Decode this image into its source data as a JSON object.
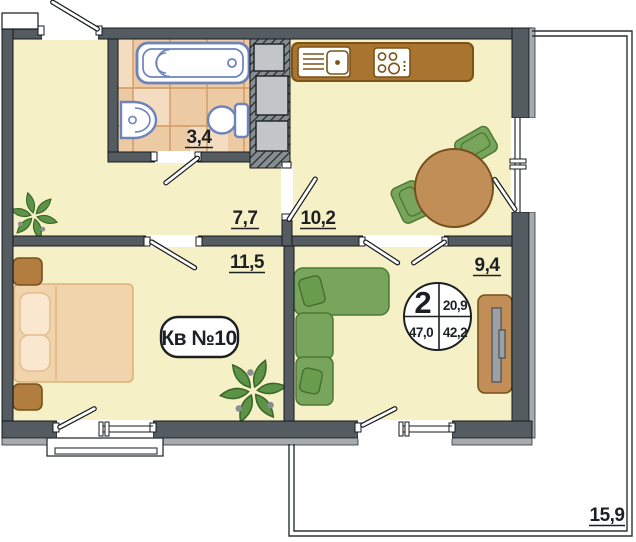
{
  "plan": {
    "apartment_badge": "Кв №10",
    "info_circle": {
      "rooms_count": "2",
      "living_area": "20,9",
      "total_area_with_balcony": "47,0",
      "total_area": "42,2"
    },
    "rooms": [
      {
        "id": "bathroom",
        "area": "3,4"
      },
      {
        "id": "hallway",
        "area": "7,7"
      },
      {
        "id": "kitchen",
        "area": "10,2"
      },
      {
        "id": "bedroom",
        "area": "11,5"
      },
      {
        "id": "living-room",
        "area": "9,4"
      },
      {
        "id": "terrace",
        "area": "15,9"
      }
    ],
    "furniture": {
      "bathroom": [
        "bathtub",
        "washbasin",
        "toilet"
      ],
      "kitchen": [
        "counter-with-sink",
        "cooktop",
        "dining-table",
        "chairs"
      ],
      "bedroom": [
        "double-bed",
        "nightstands",
        "plant"
      ],
      "living_room": [
        "corner-sofa",
        "tv-stand"
      ],
      "hallway": [
        "plant"
      ]
    },
    "colors": {
      "wall": "#545c62",
      "floor": "#f6f0c6",
      "bath_tile": "#eccaa3",
      "wood": "#c28e57",
      "counter": "#a9742f",
      "sofa_green": "#78a55b",
      "plant_green": "#5d9346",
      "fixture_outline": "#6d84ba",
      "outer_trim": "#a6abae"
    }
  }
}
